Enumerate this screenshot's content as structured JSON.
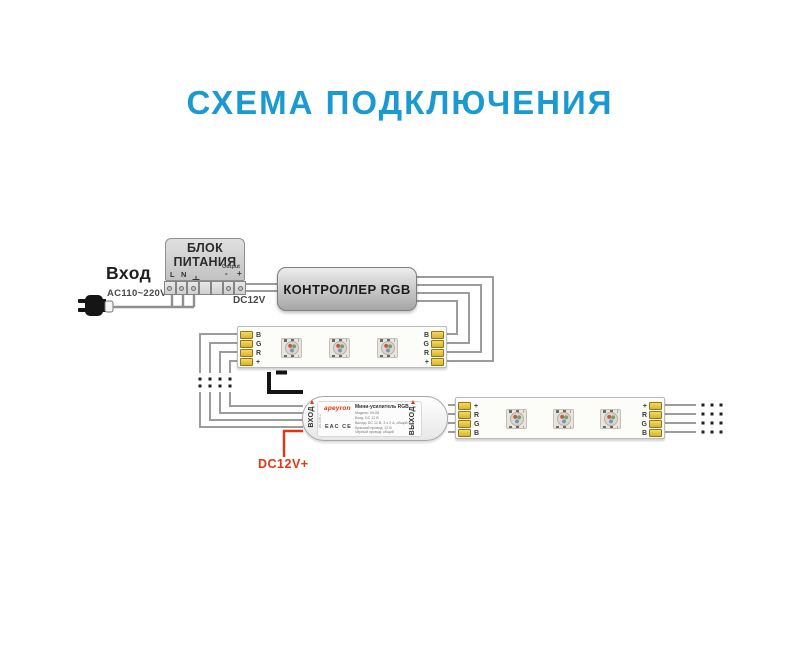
{
  "title": "СХЕМА ПОДКЛЮЧЕНИЯ",
  "input": {
    "label": "Вход",
    "voltage": "AC110~220V"
  },
  "psu": {
    "name": "БЛОК ПИТАНИЯ",
    "terminal_l": "L",
    "terminal_n": "N",
    "ground_symbol": "⏚",
    "output_label": "Output",
    "output_minus": "-",
    "output_plus": "+"
  },
  "controller": {
    "name": "КОНТРОЛЛЕР RGB",
    "supply_label": "DC12V"
  },
  "strip1": {
    "left_pads": [
      "B",
      "G",
      "R",
      "+"
    ],
    "right_pads": [
      "B",
      "G",
      "R",
      "+"
    ]
  },
  "strip2": {
    "left_pads": [
      "+",
      "R",
      "G",
      "B"
    ],
    "right_pads": [
      "+",
      "R",
      "G",
      "B"
    ]
  },
  "amplifier": {
    "brand": "apeyron",
    "title": "Мини-усилитель RGB",
    "input_label": "ВХОД",
    "output_label": "ВЫХОД",
    "sku": "AV-04617",
    "cert_marks": "EAC CE",
    "specs": [
      "Модель: 04-08",
      "Вход: DC 12 В",
      "Выход: DC 12 В, 3 x 2 А, общий 6 А",
      "Красный провод: 12 В",
      "Чёрный провод: общий"
    ]
  },
  "amp_supply_label": "DC12V+",
  "colors": {
    "accent": "#1B9AD2",
    "wire": "#9C9C9C",
    "red": "#E6340E",
    "pad": "#E9C93F"
  }
}
